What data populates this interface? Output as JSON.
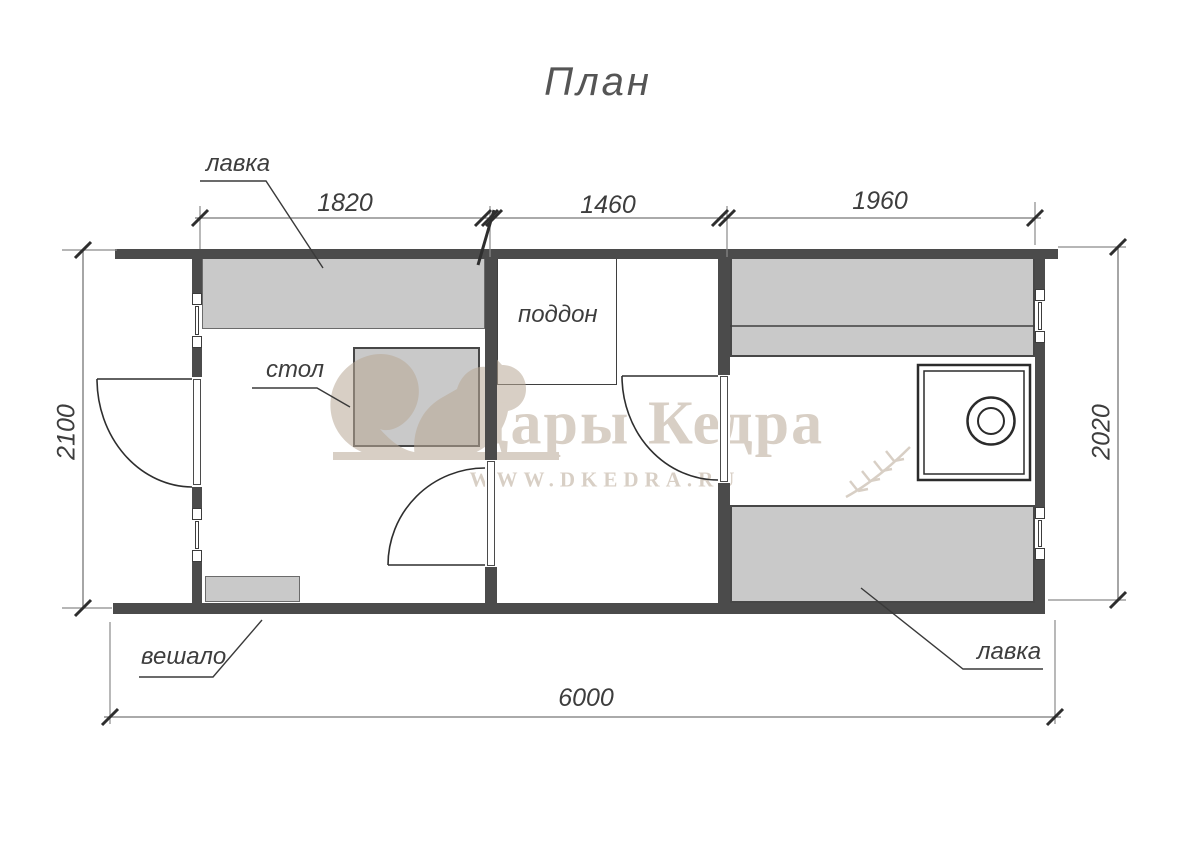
{
  "title": "План",
  "watermark": {
    "brand": "Дары Кедра",
    "url": "WWW.DKEDRA.RU"
  },
  "dimensions": {
    "top_segments": [
      "1820",
      "1460",
      "1960"
    ],
    "left": "2100",
    "right": "2020",
    "bottom": "6000"
  },
  "labels": {
    "bench_top": "лавка",
    "table": "стол",
    "tray": "поддон",
    "hanger": "вешало",
    "bench_bottom": "лавка"
  },
  "colors": {
    "wall": "#4b4b4b",
    "furniture": "#c9c9c9",
    "watermark": "#b9a996",
    "line": "#3c3c3c"
  }
}
